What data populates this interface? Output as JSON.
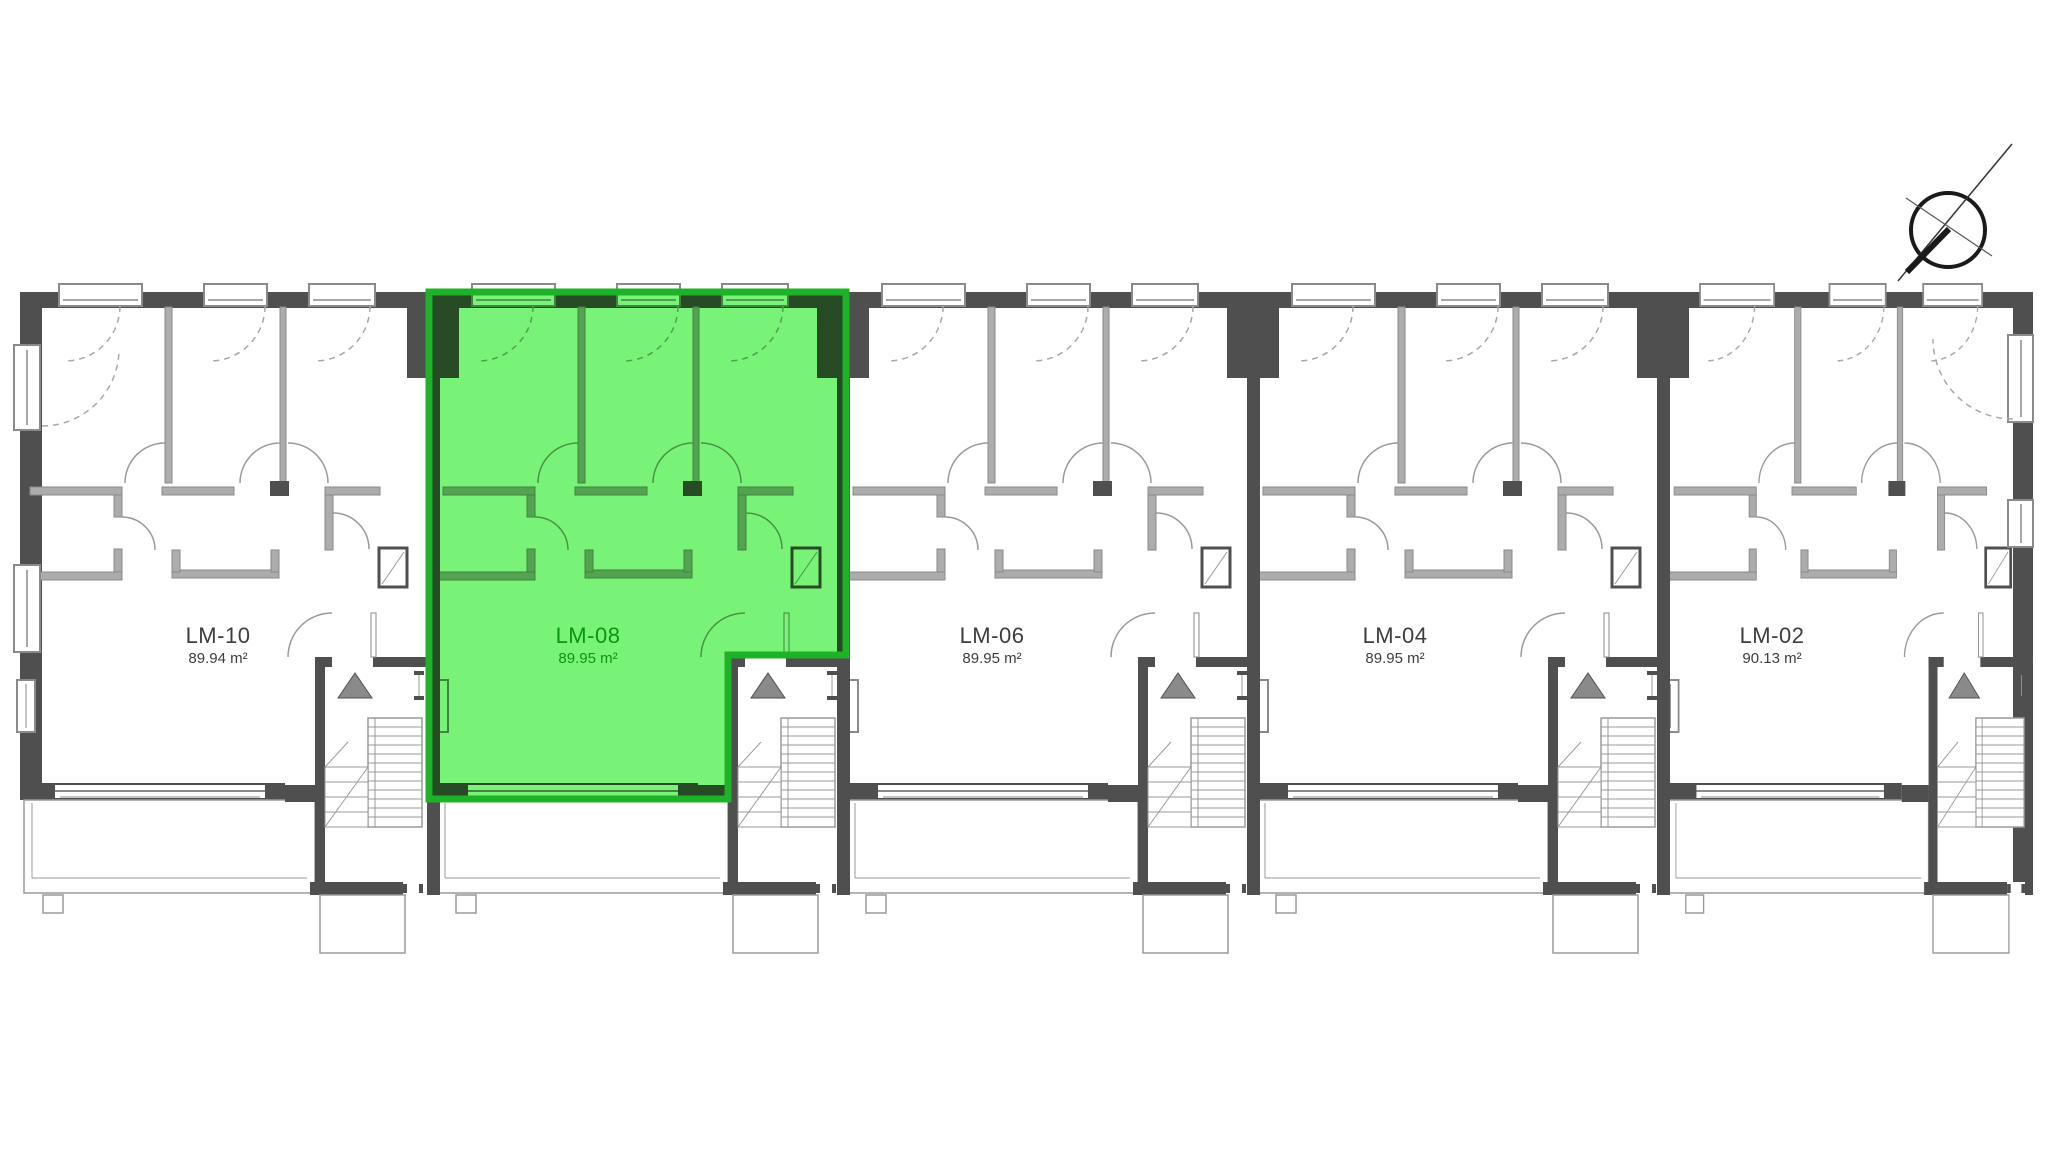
{
  "plan": {
    "title": "residential floor plan",
    "highlighted_unit": "LM-08"
  },
  "units": [
    {
      "id": "LM-10",
      "label": "LM-10",
      "area": "89.94 m²",
      "highlighted": false
    },
    {
      "id": "LM-08",
      "label": "LM-08",
      "area": "89.95 m²",
      "highlighted": true
    },
    {
      "id": "LM-06",
      "label": "LM-06",
      "area": "89.95 m²",
      "highlighted": false
    },
    {
      "id": "LM-04",
      "label": "LM-04",
      "area": "89.95 m²",
      "highlighted": false
    },
    {
      "id": "LM-02",
      "label": "LM-02",
      "area": "90.13 m²",
      "highlighted": false
    }
  ],
  "colors": {
    "highlight_fill": "#57f055",
    "highlight_border": "#1db227",
    "highlight_text": "#0b9412",
    "wall_dark": "#4f4f4f",
    "wall_light": "#acacac",
    "thin_line": "#9a9a9a",
    "label_text": "#3d3d3d"
  },
  "icons": {
    "compass": "north-arrow-icon"
  }
}
